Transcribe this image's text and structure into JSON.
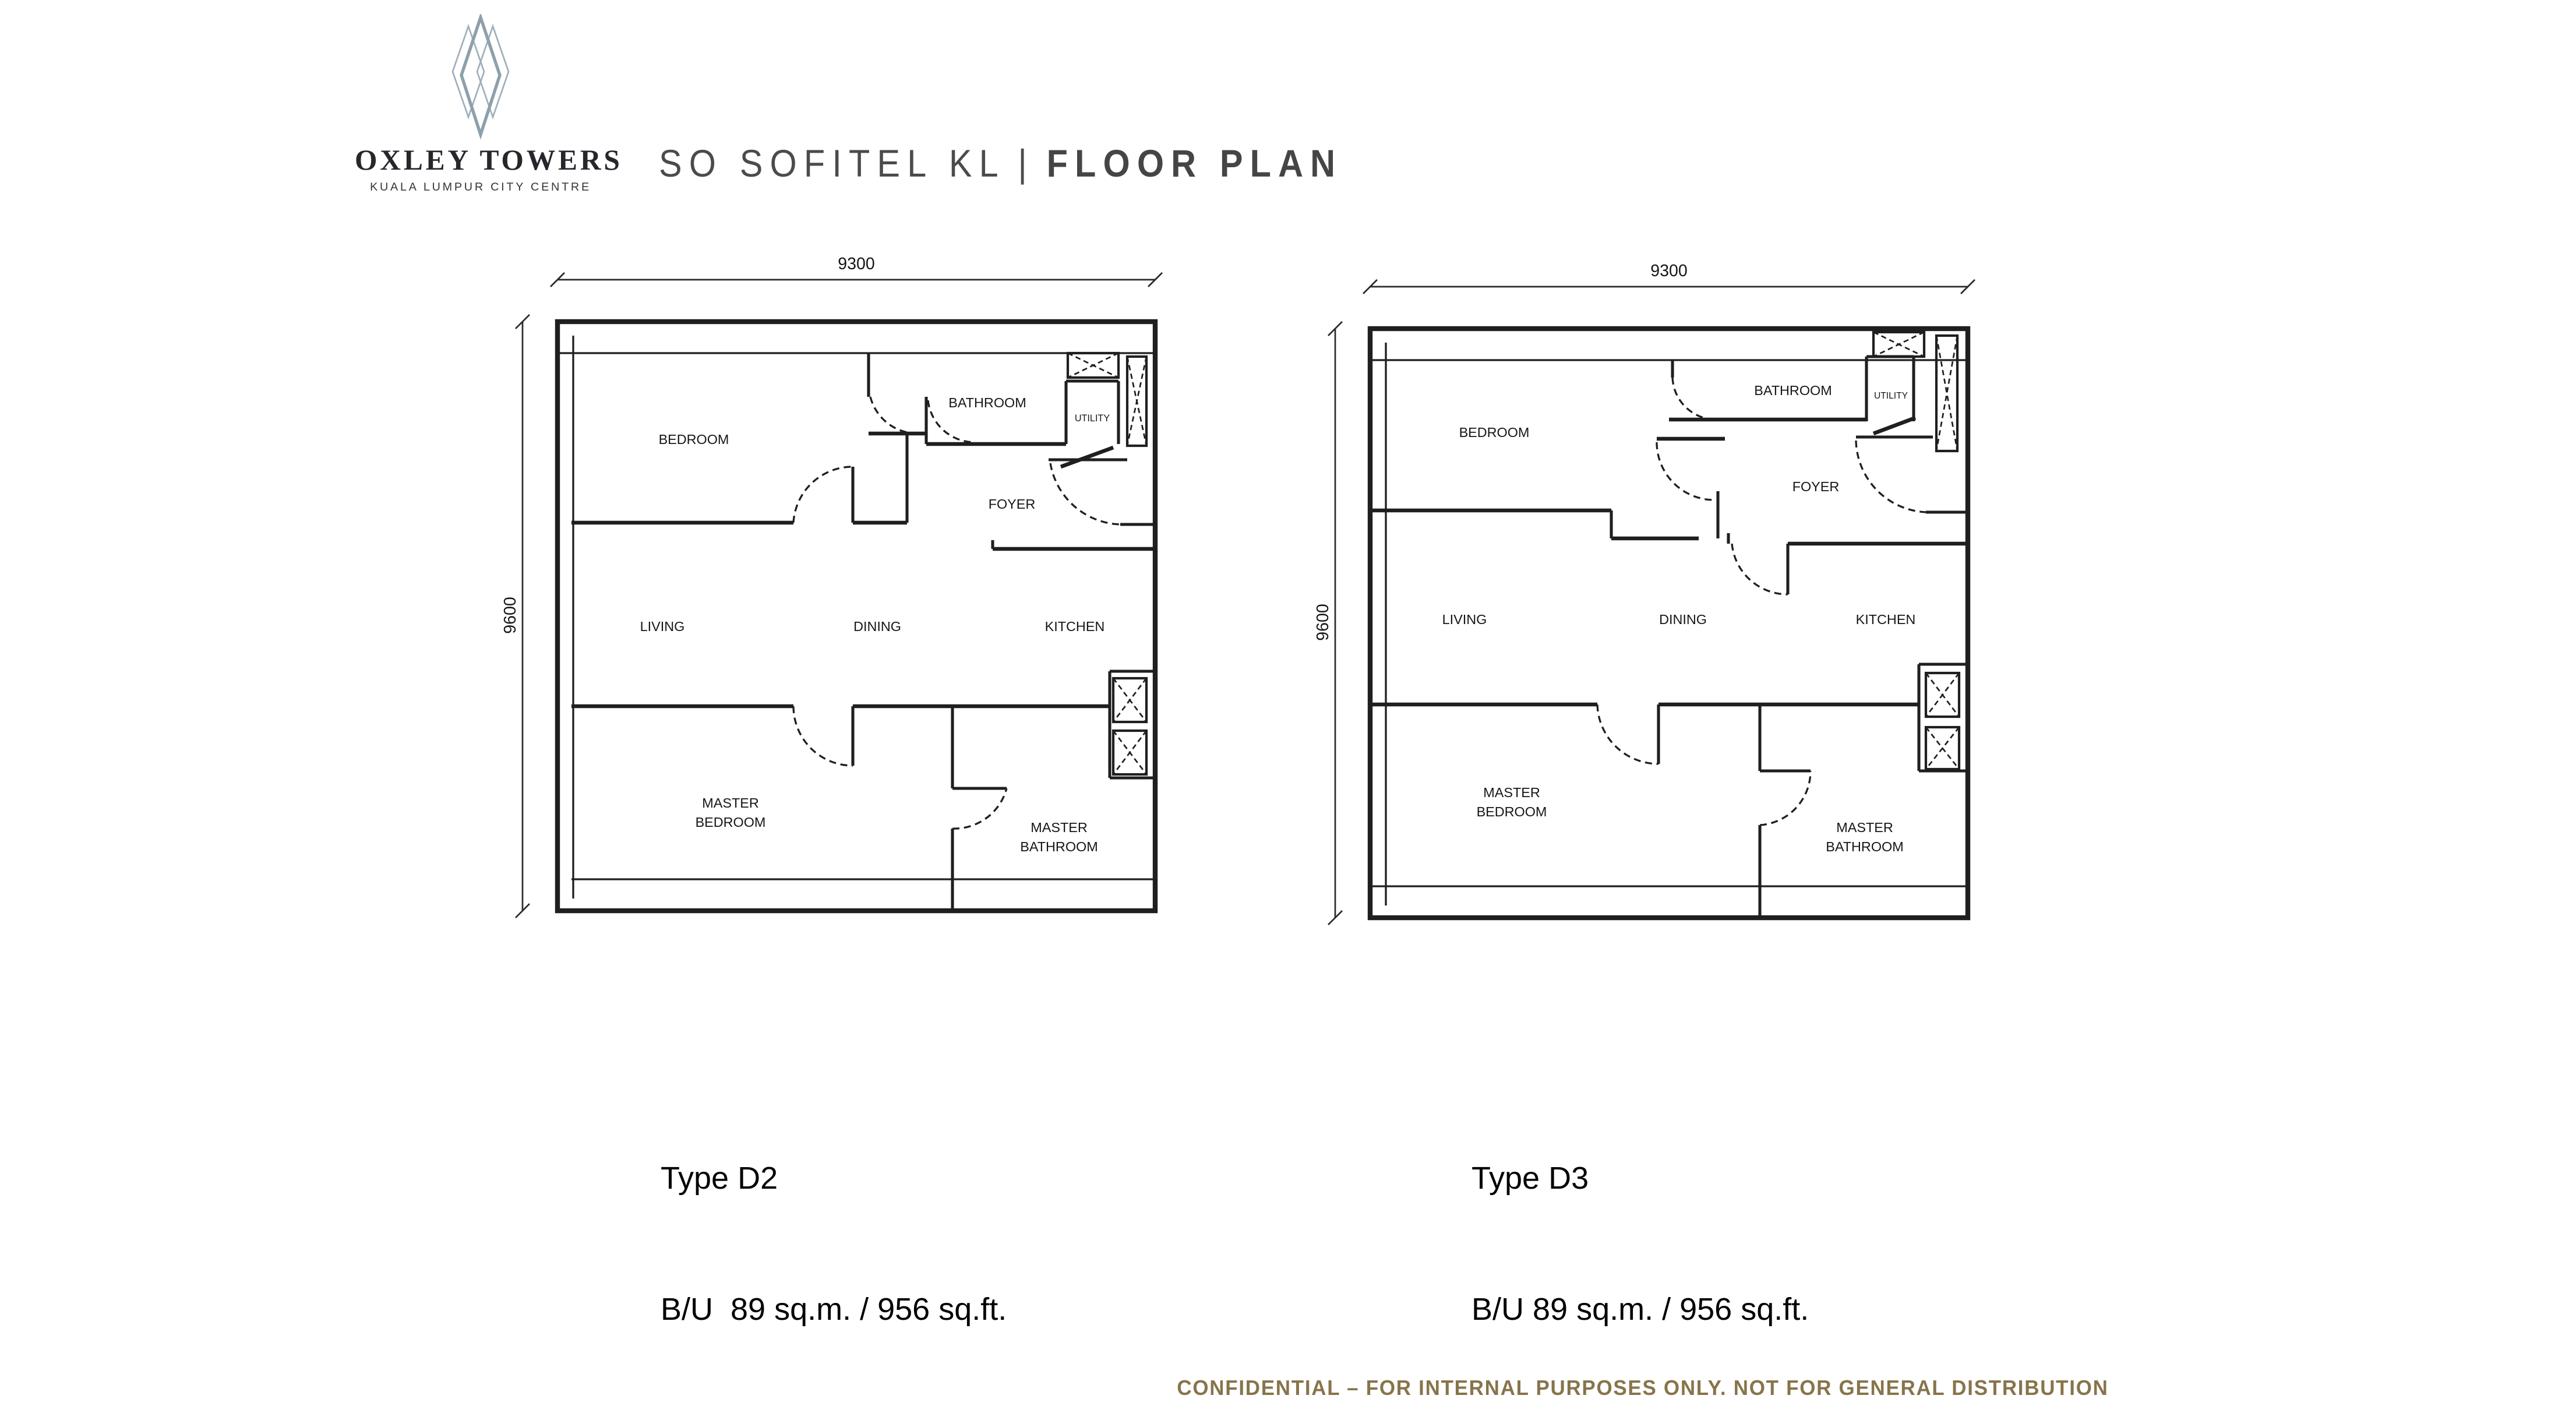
{
  "logo": {
    "brand": "OXLEY TOWERS",
    "tagline": "KUALA LUMPUR CITY CENTRE",
    "diamond_color": "#93a3af"
  },
  "header": {
    "title_project": "SO SOFITEL KL",
    "title_separator": "|",
    "title_section": "FLOOR PLAN",
    "color": "#4b4b4b"
  },
  "plans": [
    {
      "type_label": "Type D2",
      "area_label": "B/U  89 sq.m. / 956 sq.ft.",
      "dims": {
        "width": "9300",
        "height": "9600"
      },
      "rooms": {
        "bedroom": "BEDROOM",
        "bathroom": "BATHROOM",
        "utility": "UTILITY",
        "foyer": "FOYER",
        "living": "LIVING",
        "dining": "DINING",
        "kitchen": "KITCHEN",
        "master_line1": "MASTER",
        "master_line2": "BEDROOM",
        "masterbath_line1": "MASTER",
        "masterbath_line2": "BATHROOM"
      }
    },
    {
      "type_label": "Type D3",
      "area_label": "B/U 89 sq.m. / 956 sq.ft.",
      "dims": {
        "width": "9300",
        "height": "9600"
      },
      "rooms": {
        "bedroom": "BEDROOM",
        "bathroom": "BATHROOM",
        "utility": "UTILITY",
        "foyer": "FOYER",
        "living": "LIVING",
        "dining": "DINING",
        "kitchen": "KITCHEN",
        "master_line1": "MASTER",
        "master_line2": "BEDROOM",
        "masterbath_line1": "MASTER",
        "masterbath_line2": "BATHROOM"
      }
    }
  ],
  "footer": {
    "text": "CONFIDENTIAL – FOR INTERNAL PURPOSES ONLY. NOT FOR GENERAL DISTRIBUTION",
    "color": "#87744a"
  },
  "colors": {
    "line": "#1f1f1f",
    "background": "#ffffff"
  }
}
